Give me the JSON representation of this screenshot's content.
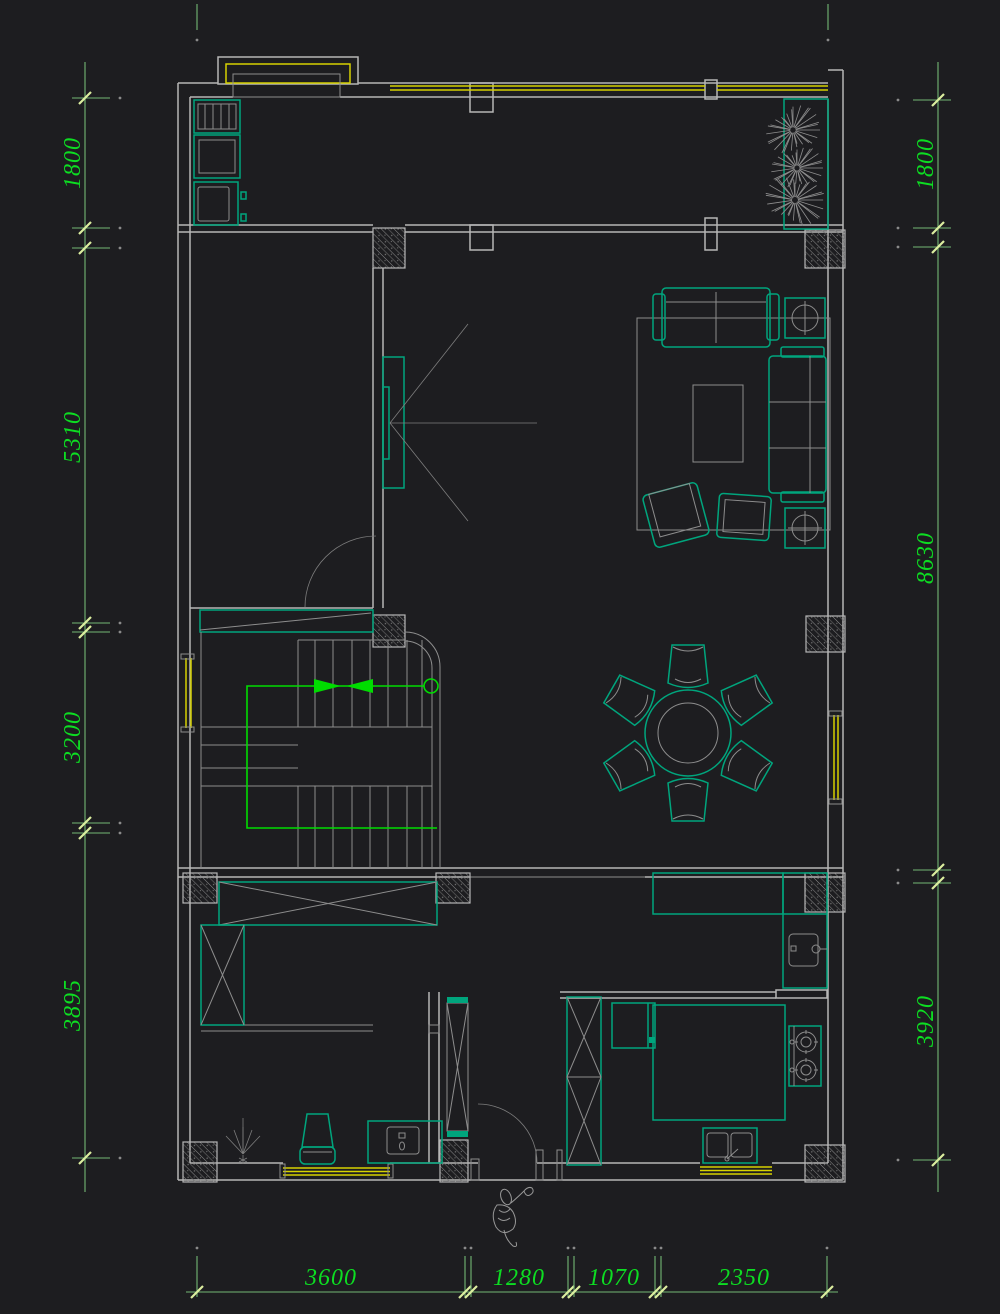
{
  "drawing": {
    "type": "cad-floor-plan",
    "dimensions": {
      "left": [
        "1800",
        "5310",
        "3200",
        "3895"
      ],
      "right": [
        "1800",
        "8630",
        "3920"
      ],
      "bottom": [
        "3600",
        "1280",
        "1070",
        "2350"
      ]
    },
    "colors": {
      "bg": "#1d1d20",
      "wall": "#b6b6b6",
      "wall2": "#8d8d8d",
      "thin": "#7d7d7d",
      "teal": "#00a57d",
      "yellow": "#d6d200",
      "dimline": "#74b874",
      "dimtext": "#0ddd22",
      "slash": "#dcee9f",
      "arrow": "#00dc00",
      "sketch": "#979797"
    }
  }
}
